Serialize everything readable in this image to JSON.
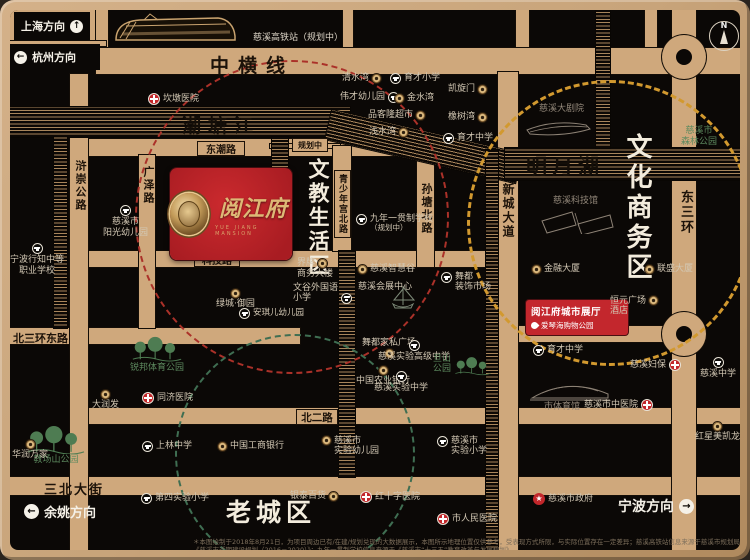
{
  "icons": {
    "up": "↑",
    "left": "←",
    "right": "→",
    "star": "★",
    "north": "N"
  },
  "top": {
    "shanghai": "上海方向",
    "hangzhou": "杭州方向",
    "station_label": "慈溪高铁站（规划中）"
  },
  "bottom": {
    "yuyao": "余姚方向",
    "ningbo": "宁波方向",
    "disclaimer": "＊本图绘制于2018年8月21日，为项目周边已有/在建/规划兑现的大数据展示，本图所示地理位置仅供参考，受表现方式所限，与实际位置存在一定差异；慈溪高铁站信息来源于慈溪市规划局《慈溪市近期建设规划（2016－2020）》；九年一贯制学校信息来源于《慈溪市“十三五”教育改革与发展规划》。"
  },
  "property": {
    "name": "阅江府",
    "subtitle": "YUE JIANG MANSION"
  },
  "showroom": {
    "line1": "阅江府城市展厅",
    "line2": "爱琴海购物公园"
  },
  "districts": {
    "wenjiao": "文教生活区",
    "wenhua": "文化商务区",
    "old_town": "老城区"
  },
  "waters": {
    "chaotang": "潮塘江",
    "mingyue": "明月湖"
  },
  "roads": {
    "zhonghengxian": "中横线",
    "dongchao": "东潮路",
    "keji": "科技路",
    "guangze": "广泽路",
    "huchong": "浒崇公路",
    "qingshaonian": "青少年宫北路",
    "suntang": "孙塘北路",
    "xincheng": "新城大道",
    "dongsanhuan": "东三环",
    "beisanhuan": "北三环东路",
    "beier": "北二路",
    "sanbei": "三北大街",
    "planned": "规划中"
  },
  "pois": {
    "kandun_hospital": {
      "label": "坎墩医院"
    },
    "qingshuiwan": {
      "label": "清水湾"
    },
    "yucai_primary": {
      "label": "育才小学"
    },
    "weicai_kg": {
      "label": "伟才幼儿园"
    },
    "jinshuiwan": {
      "label": "金水湾"
    },
    "pinkelong": {
      "label": "品客隆超市"
    },
    "qianshuiwan": {
      "label": "浅水湾"
    },
    "kaixuanmen": {
      "label": "凯旋门"
    },
    "xiangshuwan": {
      "label": "橡树湾"
    },
    "yucai_middle_n": {
      "label": "育才中学"
    },
    "grand_theater": {
      "label": "慈溪大剧院"
    },
    "forest_park": {
      "label": "慈溪市",
      "label2": "森林公园"
    },
    "science_museum": {
      "label": "慈溪科技馆"
    },
    "jinrong_tower": {
      "label": "金融大厦"
    },
    "liansheng_tower": {
      "label": "联盛大厦"
    },
    "hengyuan_hotel": {
      "label": "恒元广场",
      "label2": "酒店"
    },
    "yucai_middle_s": {
      "label": "育才中学"
    },
    "cixi_fubao": {
      "label": "慈溪妇保"
    },
    "cixi_middle": {
      "label": "慈溪中学"
    },
    "gymnasium": {
      "label": "市体育馆"
    },
    "tcm_hospital": {
      "label": "慈溪市中医院"
    },
    "hongxing": {
      "label": "红星美凯龙"
    },
    "city_gov": {
      "label": "慈溪市政府"
    },
    "jiunian_school": {
      "label": "九年一贯制学校",
      "label2": "（规划中）"
    },
    "zhihuigu": {
      "label": "慈溪智慧谷"
    },
    "huizhan_center": {
      "label": "慈溪会展中心"
    },
    "wudu_deco": {
      "label": "舞都",
      "label2": "装饰市场"
    },
    "jiepai_tower": {
      "label": "界牌",
      "label2": "商务大楼"
    },
    "wengu_school": {
      "label": "文谷外国语",
      "label2": "小学"
    },
    "anqier_kg": {
      "label": "安琪儿幼儿园"
    },
    "lvcheng_yuyuan": {
      "label": "绿城·御园"
    },
    "yangguang_kg": {
      "label": "慈溪市",
      "label2": "阳光幼儿园"
    },
    "xingzhi_school": {
      "label": "宁波行知中等",
      "label2": "职业学校"
    },
    "ruibang_park": {
      "label": "锐邦体育公园"
    },
    "darunfa": {
      "label": "大润发"
    },
    "tongji_hospital": {
      "label": "同济医院"
    },
    "jiaochangshan_park": {
      "label": "教场山公园"
    },
    "huarun": {
      "label": "华润万家"
    },
    "shanglin_middle": {
      "label": "上林中学"
    },
    "icbc": {
      "label": "中国工商银行"
    },
    "fourth_primary": {
      "label": "第四实验小学"
    },
    "yintai": {
      "label": "银泰百货"
    },
    "redcross_hospital": {
      "label": "红十字医院"
    },
    "shiyan_kg": {
      "label": "慈溪市",
      "label2": "实验幼儿园"
    },
    "shiyan_primary": {
      "label": "慈溪市",
      "label2": "实验小学"
    },
    "renmin_hospital": {
      "label": "市人民医院"
    },
    "abc_bank": {
      "label": "中国农业银行"
    },
    "wudu_furniture": {
      "label": "舞都家私广场"
    },
    "shiyan_senior": {
      "label": "慈溪实验高级中学"
    },
    "shiyan_middle": {
      "label": "慈溪实验中学"
    },
    "danshan_park": {
      "label": "旦山",
      "label2": "公园"
    }
  }
}
